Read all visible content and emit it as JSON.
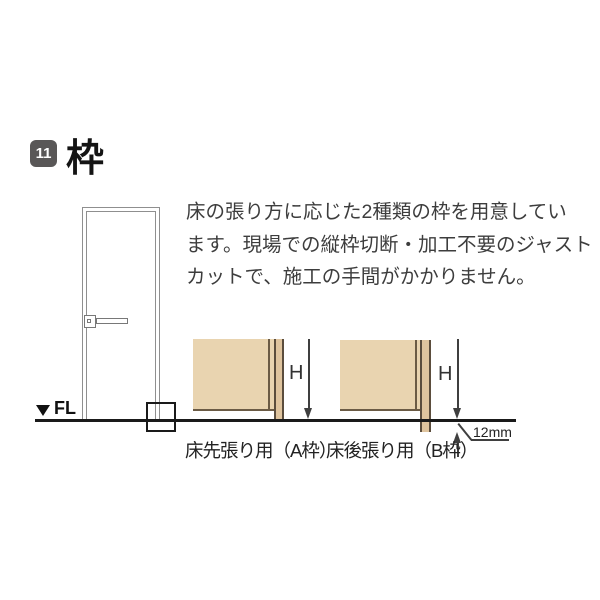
{
  "header": {
    "badge": "11",
    "title": "枠"
  },
  "intro": {
    "lines": [
      "床の張り方に応じた2種類の枠を用意してい",
      "ます。現場での縦枠切断・加工不要のジャスト",
      "カットで、施工の手間がかかりません。"
    ]
  },
  "door": {
    "fl_label": "FL"
  },
  "diagrams": {
    "a": {
      "caption": "床先張り用（A枠）",
      "dim": "H"
    },
    "b": {
      "caption": "床後張り用（B枠）",
      "dim": "H",
      "offset": "12mm"
    }
  },
  "colors": {
    "badge": "#595757",
    "wall": "#e9d4b0",
    "frame": "#dfc49e",
    "frame_edge": "#5b4d3d",
    "floor_line": "#1a1a1a",
    "dimension_line": "#3f3f3f",
    "text": "#3d3d3d"
  }
}
